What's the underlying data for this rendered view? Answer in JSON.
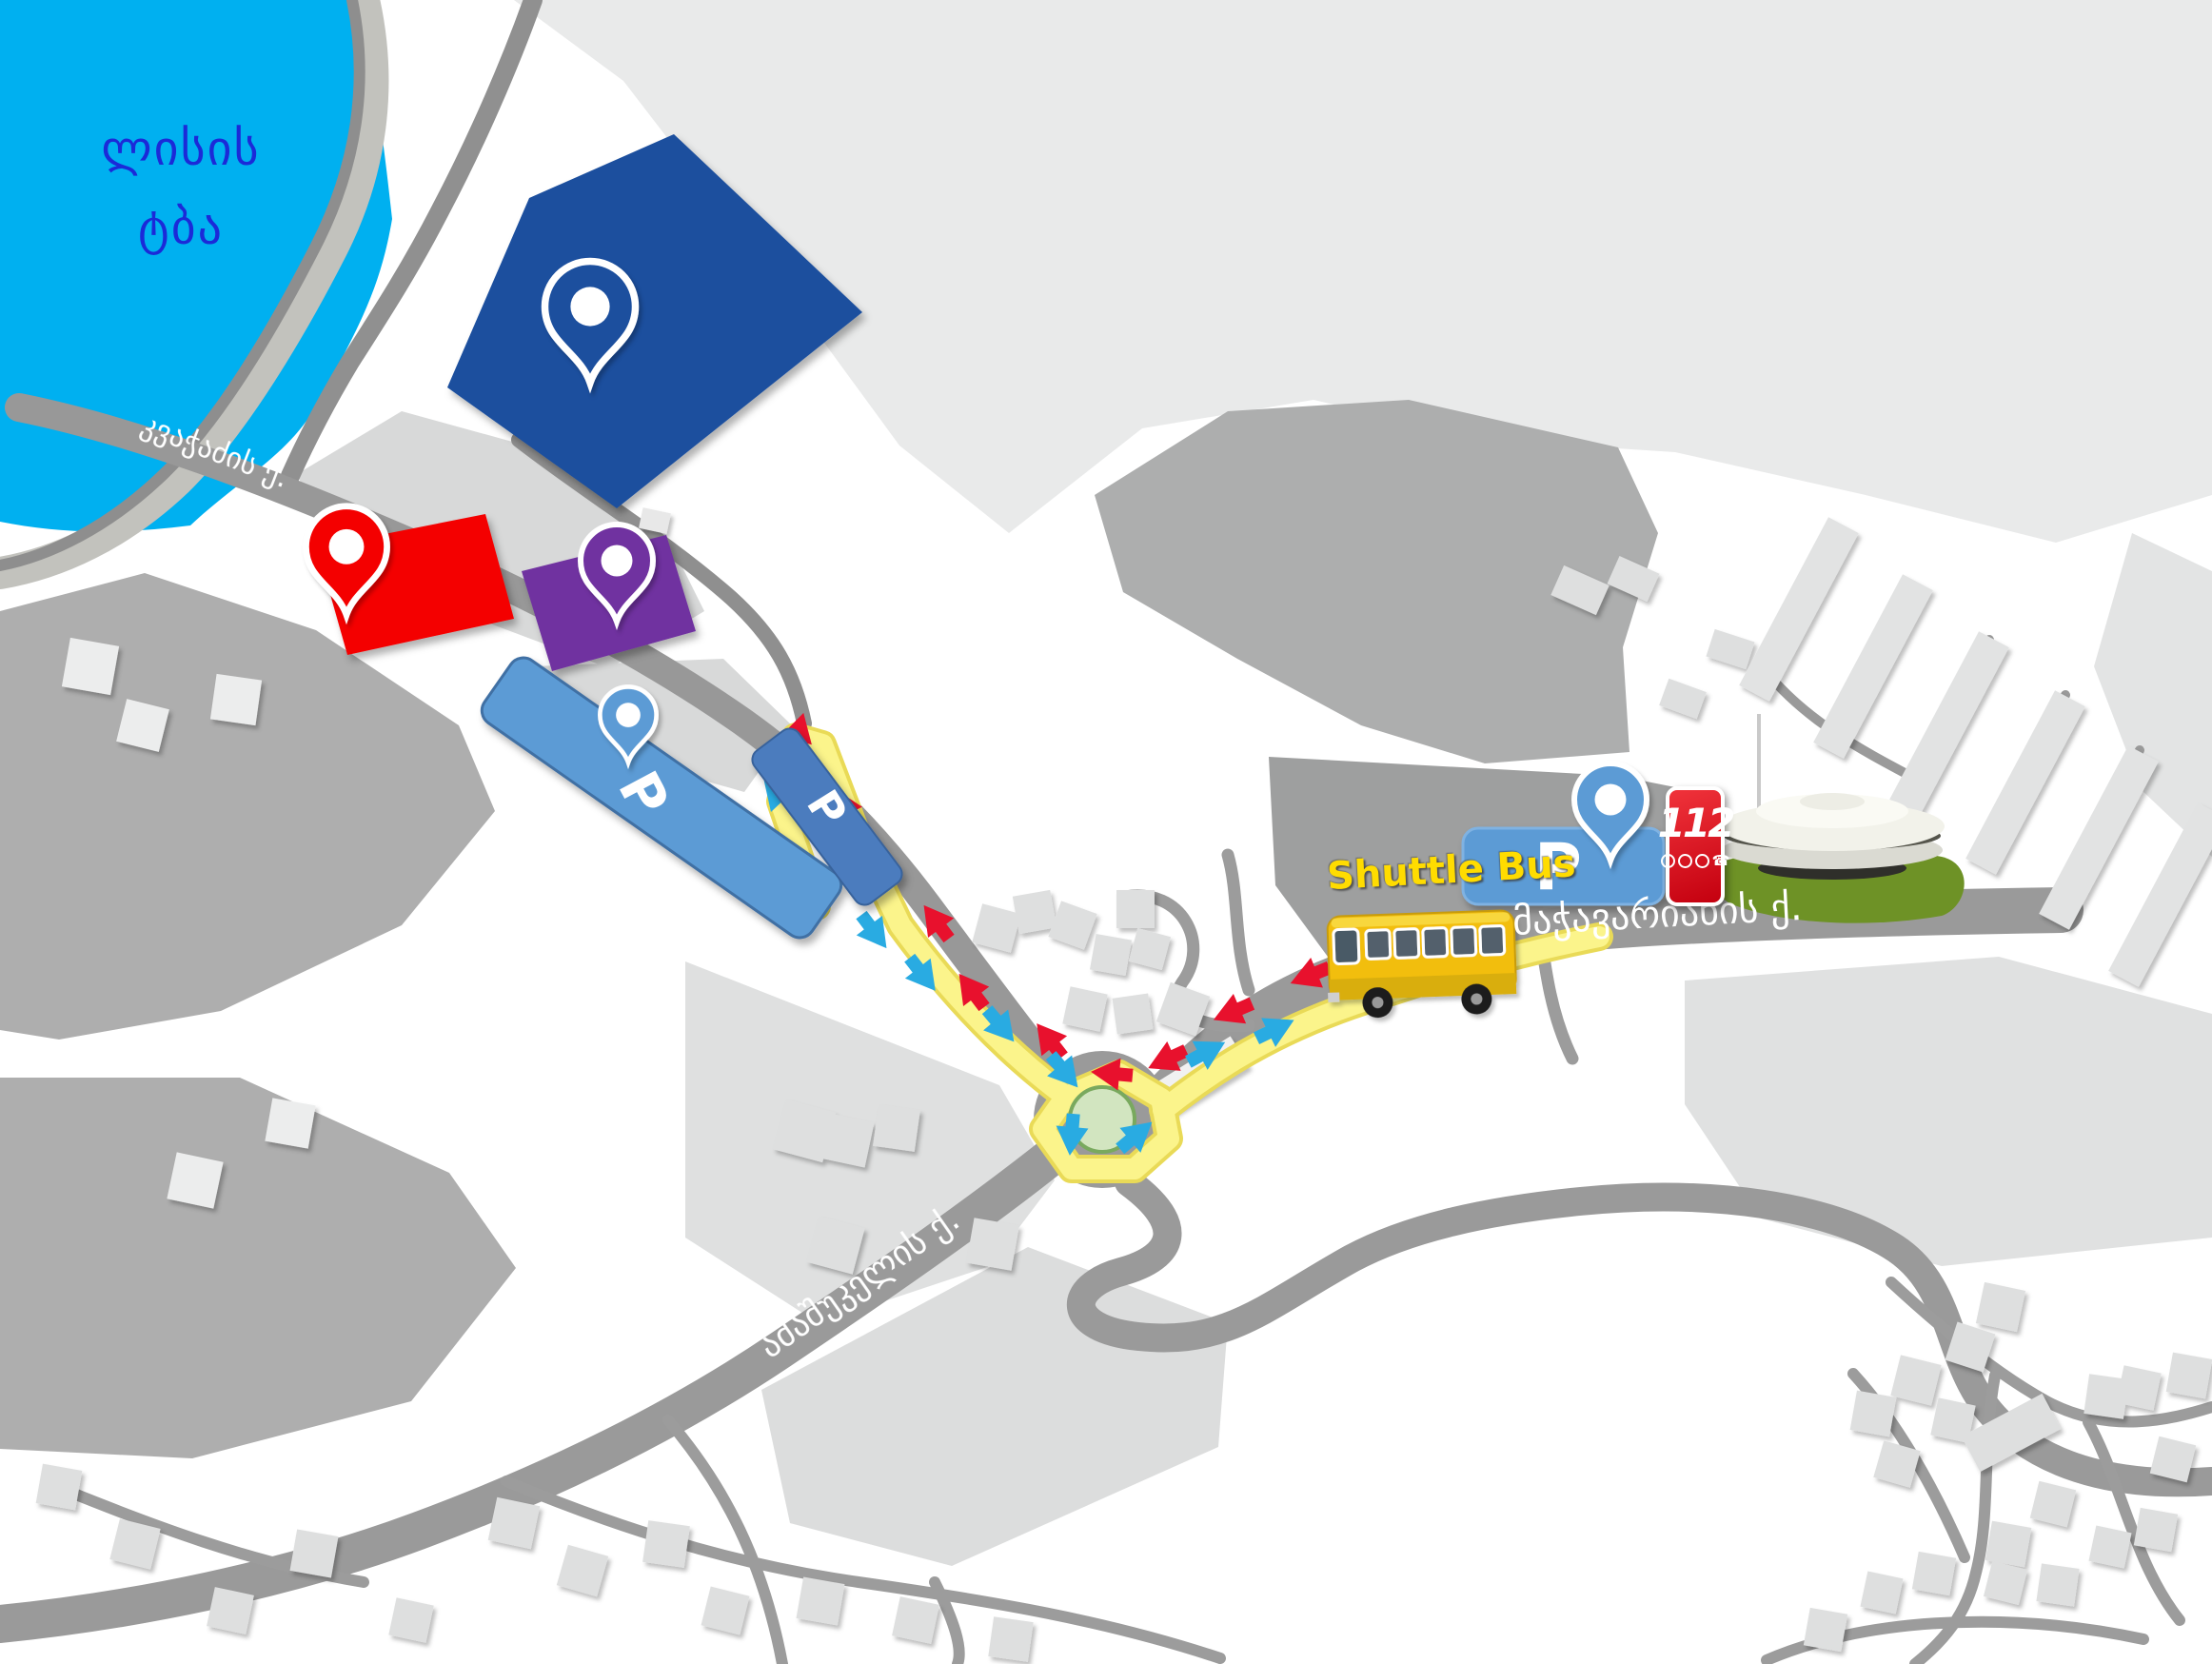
{
  "lake": {
    "line1": "ლისის",
    "line2": "ტბა"
  },
  "area_labels": {
    "unofficial": {
      "line1": "არაოფიციალური",
      "line2": "ნაწილი"
    },
    "official": {
      "line1": "ოფიციალური",
      "line2": "ნაწილი"
    },
    "tech_expo": {
      "line1": "ტექნიკის",
      "line2": "გამოფენა"
    },
    "guest_parking": {
      "line1": "პარკინგი",
      "line2": "სტუმრებისთვის"
    },
    "mia_parking": {
      "line1": "პარკინგი შსს",
      "line2": "თანამშრომლებისთვის"
    }
  },
  "streets": {
    "kvachadze": "კვაჭაძის ქ.",
    "machavariani": "მაჭავარიანის ქ.",
    "amashukeli": "ამაშუკელის ქ.",
    "beritashvili": "ბერიტაშვილის ქ."
  },
  "markers": {
    "shuttle_bus": "Shuttle Bus",
    "parking_letter": "P",
    "emergency_number": "112"
  },
  "colors": {
    "lake": "#00B0F0",
    "lake_text": "#1B2AD8",
    "unofficial_area": "#1B4F9E",
    "official_area": "#F40000",
    "tech_expo_area": "#7030A0",
    "parking": "#5B9BD5",
    "parking_dark": "#4B7CBE",
    "route": "#FAF387",
    "arrow_to_venue": "#E8112D",
    "arrow_from_venue": "#29ABE2",
    "roundabout_green": "#D2E5C0",
    "lawn": "#6E9226",
    "bus_yellow": "#F2BE0A",
    "emergency_red": "#D81F26",
    "shuttle_text": "#FFDC00"
  }
}
